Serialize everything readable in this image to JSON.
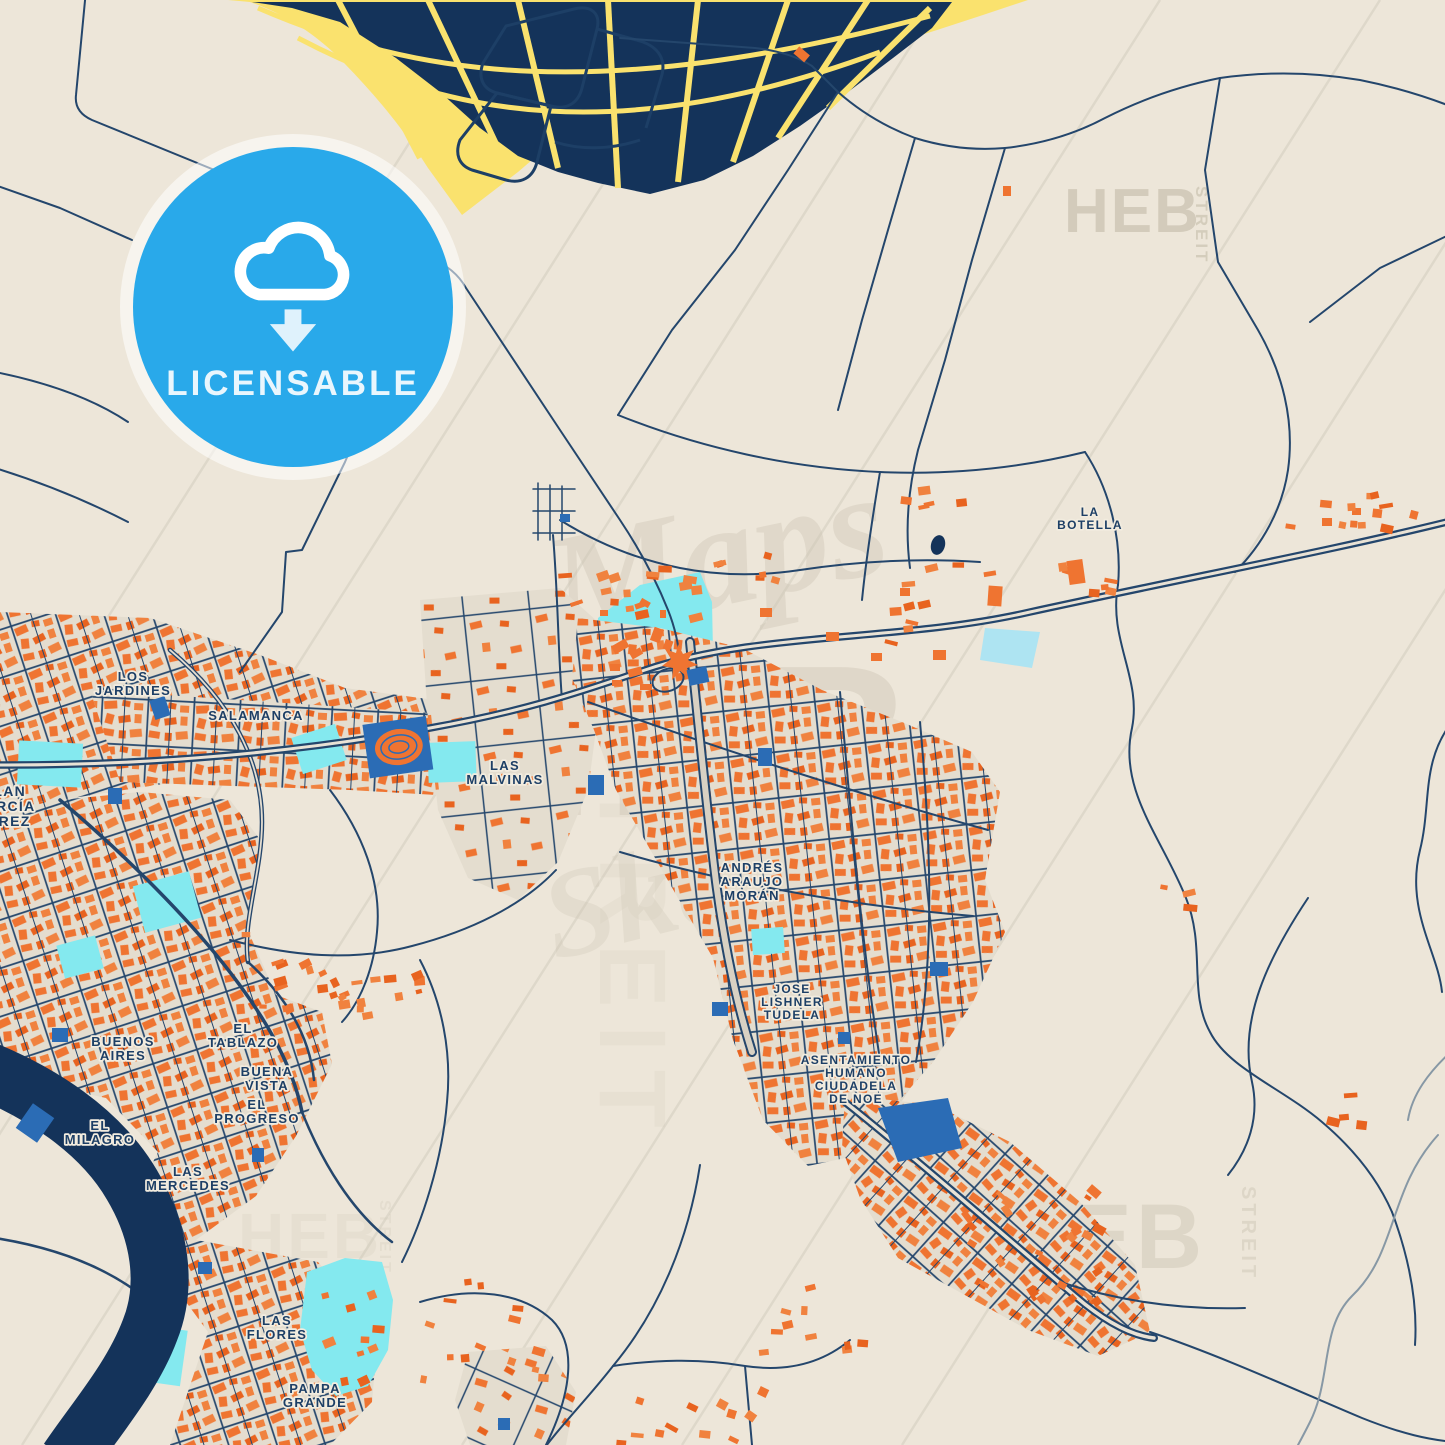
{
  "badge": {
    "label": "LICENSABLE",
    "icon": "cloud-download"
  },
  "watermarks": {
    "brand": "HEB",
    "brand_sub": "STREIT",
    "script1": "Maps",
    "script2": "Sketch",
    "items": [
      {
        "text": "Maps",
        "x": 560,
        "y": 640,
        "size": 150,
        "rotate": -12,
        "opacity": 0.42,
        "font": "script"
      },
      {
        "text": "HEB",
        "x": 440,
        "y": 815,
        "size": 215,
        "rotate": 0,
        "opacity": 0.45,
        "font": "bold",
        "ls": 10
      },
      {
        "text": "STREIT",
        "x": 600,
        "y": 700,
        "size": 95,
        "rotate": 90,
        "opacity": 0.18,
        "font": "bold",
        "ls": 18
      },
      {
        "text": "Sketch",
        "x": 555,
        "y": 960,
        "size": 125,
        "rotate": -14,
        "opacity": 0.3,
        "font": "script"
      },
      {
        "text": "HEB",
        "x": 1064,
        "y": 232,
        "size": 62,
        "rotate": 0,
        "opacity": 0.85,
        "font": "bold",
        "ls": 2
      },
      {
        "text": "STREIT",
        "x": 1196,
        "y": 186,
        "size": 17,
        "rotate": 90,
        "opacity": 0.8,
        "font": "bold",
        "ls": 3
      },
      {
        "text": "HEB",
        "x": 1000,
        "y": 1268,
        "size": 92,
        "rotate": 0,
        "opacity": 0.5,
        "font": "bold",
        "ls": 4
      },
      {
        "text": "STREIT",
        "x": 1242,
        "y": 1186,
        "size": 20,
        "rotate": 90,
        "opacity": 0.5,
        "font": "bold",
        "ls": 4
      },
      {
        "text": "HEB",
        "x": 238,
        "y": 1258,
        "size": 64,
        "rotate": 0,
        "opacity": 0.2,
        "font": "bold",
        "ls": 3
      },
      {
        "text": "STREIT",
        "x": 380,
        "y": 1200,
        "size": 16,
        "rotate": 90,
        "opacity": 0.28,
        "font": "bold",
        "ls": 3
      }
    ]
  },
  "map_labels": [
    {
      "id": "alan-garcia-perez",
      "lines": [
        "ALAN",
        "GARCÍA",
        "PÉREZ"
      ],
      "x": 4,
      "y": 796,
      "size": 14
    },
    {
      "id": "los-jardines",
      "lines": [
        "LOS",
        "JARDINES"
      ],
      "x": 133,
      "y": 681
    },
    {
      "id": "salamanca",
      "lines": [
        "SALAMANCA"
      ],
      "x": 256,
      "y": 720
    },
    {
      "id": "las-malvinas",
      "lines": [
        "LAS",
        "MALVINAS"
      ],
      "x": 505,
      "y": 770
    },
    {
      "id": "andres-araujo-moran",
      "lines": [
        "ANDRÉS",
        "ARAUJO",
        "MORÁN"
      ],
      "x": 752,
      "y": 872
    },
    {
      "id": "jose-lishner-tudela",
      "lines": [
        "JOSE",
        "LISHNER",
        "TUDELA"
      ],
      "x": 792,
      "y": 993,
      "size": 12
    },
    {
      "id": "asentamiento-humano-ciudadela-de-noe",
      "lines": [
        "ASENTAMIENTO",
        "HUMANO",
        "CIUDADELA",
        "DE NOE"
      ],
      "x": 856,
      "y": 1064,
      "size": 12
    },
    {
      "id": "buenos-aires",
      "lines": [
        "BUENOS",
        "AIRES"
      ],
      "x": 123,
      "y": 1046
    },
    {
      "id": "el-tablazo",
      "lines": [
        "EL",
        "TABLAZO"
      ],
      "x": 243,
      "y": 1033
    },
    {
      "id": "buena-vista",
      "lines": [
        "BUENA",
        "VISTA"
      ],
      "x": 267,
      "y": 1076
    },
    {
      "id": "el-progreso",
      "lines": [
        "EL",
        "PROGRESO"
      ],
      "x": 257,
      "y": 1109
    },
    {
      "id": "el-milagro",
      "lines": [
        "EL",
        "MILAGRO"
      ],
      "x": 100,
      "y": 1130
    },
    {
      "id": "las-mercedes",
      "lines": [
        "LAS",
        "MERCEDES"
      ],
      "x": 188,
      "y": 1176
    },
    {
      "id": "las-flores",
      "lines": [
        "LAS",
        "FLORES"
      ],
      "x": 277,
      "y": 1325
    },
    {
      "id": "pampa-grande",
      "lines": [
        "PAMPA",
        "GRANDE"
      ],
      "x": 315,
      "y": 1393
    },
    {
      "id": "la-botella",
      "lines": [
        "LA",
        "BOTELLA"
      ],
      "x": 1090,
      "y": 516,
      "size": 12
    }
  ],
  "colors": {
    "background": "#ede6d9",
    "land_yellow": "#fae26e",
    "blocks_navy": "#14335a",
    "road_navy": "#24466c",
    "building_orange": "#ef7431",
    "building_orange_dark": "#e8631f",
    "building_orange_light": "#f0823f",
    "water_cyan": "#84e9ef",
    "institution_blue": "#2b6cb5",
    "river_navy": "#14335a",
    "badge_blue": "#29a9ea",
    "label_navy": "#1d3f66",
    "watermark_gray": "#cfc7b6",
    "powerline_gray": "#dcd6c8"
  }
}
